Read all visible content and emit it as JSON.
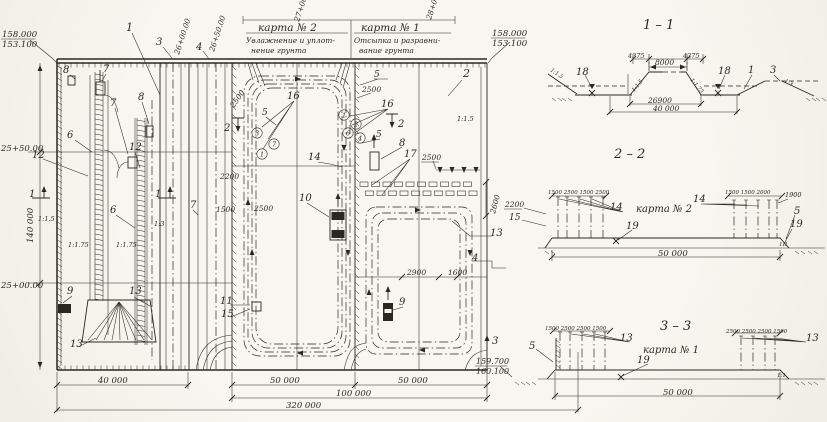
{
  "colors": {
    "paper": "#f6f4ed",
    "ink": "#2b2822"
  },
  "labels": [
    {
      "n": "elevation-top-left-upper",
      "t": "158.000",
      "x": 2,
      "y": 37,
      "fs": 8.5,
      "ul": 1
    },
    {
      "n": "elevation-top-left-lower",
      "t": "153.100",
      "x": 2,
      "y": 47,
      "fs": 8.5
    },
    {
      "n": "pos-1",
      "t": "1",
      "x": 126,
      "y": 31,
      "fs": 11
    },
    {
      "n": "pos-3",
      "t": "3",
      "x": 156,
      "y": 45,
      "fs": 10
    },
    {
      "n": "pos-4",
      "t": "4",
      "x": 196,
      "y": 50,
      "fs": 10
    },
    {
      "n": "station-axis-a",
      "t": "26+00.00",
      "x": 179,
      "y": 55,
      "fs": 7.5,
      "r": -72
    },
    {
      "n": "station-axis-b",
      "t": "26+50.00",
      "x": 214,
      "y": 52,
      "fs": 7.5,
      "r": -72
    },
    {
      "n": "station-axis-c",
      "t": "27+00",
      "x": 299,
      "y": 22,
      "fs": 7.5,
      "r": -72
    },
    {
      "n": "station-axis-d",
      "t": "28+00",
      "x": 431,
      "y": 20,
      "fs": 7.5,
      "r": -72
    },
    {
      "n": "map2-title",
      "t": "карта  № 2",
      "x": 258,
      "y": 31,
      "fs": 10.5
    },
    {
      "n": "map2-subtitle-1",
      "t": "Увлажнение и уплот-",
      "x": 246,
      "y": 43,
      "fs": 7.5
    },
    {
      "n": "map2-subtitle-2",
      "t": "нение грунта",
      "x": 251,
      "y": 53,
      "fs": 7.5
    },
    {
      "n": "map1-title",
      "t": "карта  № 1",
      "x": 361,
      "y": 31,
      "fs": 10.5
    },
    {
      "n": "map1-subtitle-1",
      "t": "Отсыпка и разравни-",
      "x": 354,
      "y": 43,
      "fs": 7.5
    },
    {
      "n": "map1-subtitle-2",
      "t": "вание грунта",
      "x": 359,
      "y": 53,
      "fs": 7.5
    },
    {
      "n": "elevation-top-right-upper",
      "t": "158.000",
      "x": 492,
      "y": 36,
      "fs": 8.5,
      "ul": 1
    },
    {
      "n": "elevation-top-right-lower",
      "t": "153.100",
      "x": 492,
      "y": 46,
      "fs": 8.5
    },
    {
      "n": "pos-2",
      "t": "2",
      "x": 463,
      "y": 77,
      "fs": 11
    },
    {
      "n": "slope-right-top",
      "t": "1:1.5",
      "x": 457,
      "y": 121,
      "fs": 6.5
    },
    {
      "n": "pos-8-a",
      "t": "8",
      "x": 63,
      "y": 73,
      "fs": 10
    },
    {
      "n": "pos-7-a",
      "t": "7",
      "x": 103,
      "y": 72,
      "fs": 10
    },
    {
      "n": "pos-7-b",
      "t": "7",
      "x": 110,
      "y": 106,
      "fs": 10
    },
    {
      "n": "pos-8-b",
      "t": "8",
      "x": 138,
      "y": 100,
      "fs": 10
    },
    {
      "n": "pos-6-a",
      "t": "6",
      "x": 67,
      "y": 138,
      "fs": 10
    },
    {
      "n": "pos-12-a",
      "t": "12",
      "x": 32,
      "y": 158,
      "fs": 10
    },
    {
      "n": "pos-12-b",
      "t": "12",
      "x": 129,
      "y": 150,
      "fs": 10
    },
    {
      "n": "pos-6-b",
      "t": "6",
      "x": 110,
      "y": 213,
      "fs": 10
    },
    {
      "n": "slope-a",
      "t": "1:1.5",
      "x": 38,
      "y": 221,
      "fs": 6.5
    },
    {
      "n": "slope-b",
      "t": "1:1.75",
      "x": 68,
      "y": 247,
      "fs": 6.5
    },
    {
      "n": "slope-c",
      "t": "1:1.75",
      "x": 116,
      "y": 247,
      "fs": 6.5
    },
    {
      "n": "slope-d",
      "t": "1:3",
      "x": 154,
      "y": 226,
      "fs": 6.5
    },
    {
      "n": "pos-7-c",
      "t": "7",
      "x": 190,
      "y": 208,
      "fs": 10
    },
    {
      "n": "pos-9-a",
      "t": "9",
      "x": 67,
      "y": 294,
      "fs": 10
    },
    {
      "n": "pos-13-a",
      "t": "13",
      "x": 129,
      "y": 294,
      "fs": 10
    },
    {
      "n": "pos-13-b",
      "t": "13",
      "x": 70,
      "y": 347,
      "fs": 10
    },
    {
      "n": "station-pk-25-50",
      "t": "25+50.00",
      "x": 1,
      "y": 151,
      "fs": 8.5
    },
    {
      "n": "station-pk-25-00",
      "t": "25+00.00",
      "x": 1,
      "y": 288,
      "fs": 8.5
    },
    {
      "n": "dim-140000",
      "t": "140 000",
      "x": 33,
      "y": 243,
      "fs": 8.5,
      "r": -90
    },
    {
      "n": "section-mark-1-left",
      "t": "1",
      "x": 29,
      "y": 197,
      "fs": 10
    },
    {
      "n": "section-mark-1-right",
      "t": "1",
      "x": 155,
      "y": 197,
      "fs": 10
    },
    {
      "n": "pos-5-a",
      "t": "5",
      "x": 262,
      "y": 115,
      "fs": 9
    },
    {
      "n": "route-point-3",
      "t": "3",
      "x": 257,
      "y": 133,
      "fs": 6.5,
      "c": 1
    },
    {
      "n": "route-point-7",
      "t": "7",
      "x": 274,
      "y": 144,
      "fs": 6.5,
      "c": 1
    },
    {
      "n": "route-point-1a",
      "t": "1",
      "x": 262,
      "y": 154,
      "fs": 6.5,
      "c": 1
    },
    {
      "n": "pos-16-a",
      "t": "16",
      "x": 287,
      "y": 99,
      "fs": 10
    },
    {
      "n": "dim-2500-a",
      "t": "2500",
      "x": 234,
      "y": 108,
      "fs": 7.5,
      "r": -55
    },
    {
      "n": "dim-2200-a",
      "t": "2200",
      "x": 220,
      "y": 179,
      "fs": 7.5
    },
    {
      "n": "dim-1500-a",
      "t": "1500",
      "x": 216,
      "y": 212,
      "fs": 7.5
    },
    {
      "n": "dim-2500-b",
      "t": "2500",
      "x": 254,
      "y": 211,
      "fs": 7.5
    },
    {
      "n": "section-mark-2-left",
      "t": "2",
      "x": 224,
      "y": 131,
      "fs": 10
    },
    {
      "n": "section-mark-2-right",
      "t": "2",
      "x": 398,
      "y": 127,
      "fs": 10
    },
    {
      "n": "pos-14-a",
      "t": "14",
      "x": 308,
      "y": 160,
      "fs": 10
    },
    {
      "n": "pos-10",
      "t": "10",
      "x": 299,
      "y": 201,
      "fs": 10
    },
    {
      "n": "pos-11",
      "t": "11",
      "x": 220,
      "y": 304,
      "fs": 10
    },
    {
      "n": "pos-15-a",
      "t": "15",
      "x": 221,
      "y": 317,
      "fs": 10
    },
    {
      "n": "route-point-1b",
      "t": "1",
      "x": 344,
      "y": 115,
      "fs": 6.5,
      "c": 1
    },
    {
      "n": "route-point-2",
      "t": "2",
      "x": 356,
      "y": 124,
      "fs": 6.5,
      "c": 1
    },
    {
      "n": "route-point-6",
      "t": "6",
      "x": 348,
      "y": 133,
      "fs": 6.5,
      "c": 1
    },
    {
      "n": "route-point-4",
      "t": "4",
      "x": 360,
      "y": 138,
      "fs": 6.5,
      "c": 1
    },
    {
      "n": "pos-5-b",
      "t": "5",
      "x": 374,
      "y": 77,
      "fs": 9
    },
    {
      "n": "dim-2500-c",
      "t": "2500",
      "x": 362,
      "y": 92,
      "fs": 7.5
    },
    {
      "n": "pos-16-b",
      "t": "16",
      "x": 381,
      "y": 107,
      "fs": 10
    },
    {
      "n": "pos-5-c",
      "t": "5",
      "x": 376,
      "y": 137,
      "fs": 9
    },
    {
      "n": "pos-8-c",
      "t": "8",
      "x": 399,
      "y": 146,
      "fs": 10
    },
    {
      "n": "pos-17",
      "t": "17",
      "x": 404,
      "y": 157,
      "fs": 10
    },
    {
      "n": "dim-2500-d",
      "t": "2500",
      "x": 422,
      "y": 160,
      "fs": 7.5,
      "ul": 1
    },
    {
      "n": "dim-2600",
      "t": "2600",
      "x": 495,
      "y": 214,
      "fs": 7.5,
      "r": -75
    },
    {
      "n": "pos-13-c",
      "t": "13",
      "x": 490,
      "y": 236,
      "fs": 10
    },
    {
      "n": "pos-4-b",
      "t": "4",
      "x": 472,
      "y": 261,
      "fs": 10
    },
    {
      "n": "dim-2900",
      "t": "2900",
      "x": 407,
      "y": 275,
      "fs": 7.5
    },
    {
      "n": "dim-1600",
      "t": "1600",
      "x": 448,
      "y": 275,
      "fs": 7.5
    },
    {
      "n": "pos-9-b",
      "t": "9",
      "x": 399,
      "y": 305,
      "fs": 10
    },
    {
      "n": "section-mark-3",
      "t": "3",
      "x": 492,
      "y": 344,
      "fs": 10
    },
    {
      "n": "dim-40000-plan",
      "t": "40 000",
      "x": 98,
      "y": 383,
      "fs": 8.5
    },
    {
      "n": "dim-50000-plan-a",
      "t": "50 000",
      "x": 270,
      "y": 383,
      "fs": 8.5
    },
    {
      "n": "dim-50000-plan-b",
      "t": "50 000",
      "x": 398,
      "y": 383,
      "fs": 8.5
    },
    {
      "n": "dim-100000-plan",
      "t": "100 000",
      "x": 336,
      "y": 396,
      "fs": 8.5
    },
    {
      "n": "dim-320000-plan",
      "t": "320 000",
      "x": 286,
      "y": 408,
      "fs": 8.5
    },
    {
      "n": "elevation-bottom-right-upper",
      "t": "159.700",
      "x": 476,
      "y": 364,
      "fs": 8,
      "ul": 1
    },
    {
      "n": "elevation-bottom-right-lower",
      "t": "160.100",
      "x": 476,
      "y": 374,
      "fs": 8
    },
    {
      "n": "section-1-1-title",
      "t": "1 – 1",
      "x": 643,
      "y": 29,
      "fs": 13
    },
    {
      "n": "pos-18-a",
      "t": "18",
      "x": 576,
      "y": 75,
      "fs": 10
    },
    {
      "n": "slope-s1-left",
      "t": "1:1.5",
      "x": 550,
      "y": 71,
      "fs": 5.5,
      "r": 33
    },
    {
      "n": "dim-4375-left",
      "t": "4375",
      "x": 628,
      "y": 58,
      "fs": 6.5
    },
    {
      "n": "dim-8000",
      "t": "8000",
      "x": 655,
      "y": 65,
      "fs": 7.5
    },
    {
      "n": "dim-4375-right",
      "t": "4375",
      "x": 683,
      "y": 58,
      "fs": 6.5
    },
    {
      "n": "slope-s1-core-left",
      "t": "1:1.5",
      "x": 634,
      "y": 92,
      "fs": 5.5,
      "r": -50
    },
    {
      "n": "slope-s1-core-right",
      "t": "1:1.75",
      "x": 690,
      "y": 80,
      "fs": 5.5,
      "r": 50
    },
    {
      "n": "pos-18-b",
      "t": "18",
      "x": 718,
      "y": 74,
      "fs": 10
    },
    {
      "n": "pos-1-b",
      "t": "1",
      "x": 748,
      "y": 73,
      "fs": 10
    },
    {
      "n": "pos-3-b",
      "t": "3",
      "x": 770,
      "y": 73,
      "fs": 10
    },
    {
      "n": "slope-s1-right",
      "t": "1:3",
      "x": 784,
      "y": 82,
      "fs": 5.5,
      "r": 28
    },
    {
      "n": "dim-26900",
      "t": "26900",
      "x": 648,
      "y": 103,
      "fs": 7.5
    },
    {
      "n": "dim-40000-s1",
      "t": "40 000",
      "x": 653,
      "y": 111,
      "fs": 7.5
    },
    {
      "n": "section-2-2-title",
      "t": "2 – 2",
      "x": 614,
      "y": 158,
      "fs": 13
    },
    {
      "n": "dim-2200-s2",
      "t": "2200",
      "x": 505,
      "y": 207,
      "fs": 7.5,
      "ul": 1
    },
    {
      "n": "pos-15-b",
      "t": "15",
      "x": 509,
      "y": 220,
      "fs": 9
    },
    {
      "n": "dims-s2-left",
      "t": "1500 2500 1500 2500",
      "x": 548,
      "y": 194,
      "fs": 5.5
    },
    {
      "n": "pos-14-b",
      "t": "14",
      "x": 610,
      "y": 210,
      "fs": 10
    },
    {
      "n": "map2-ref-s2",
      "t": "карта № 2",
      "x": 636,
      "y": 212,
      "fs": 10
    },
    {
      "n": "pos-19-a",
      "t": "19",
      "x": 626,
      "y": 229,
      "fs": 10
    },
    {
      "n": "dims-s2-right",
      "t": "1500 1500 2000",
      "x": 725,
      "y": 194,
      "fs": 5.5
    },
    {
      "n": "dim-1900-s2",
      "t": "1900",
      "x": 785,
      "y": 197,
      "fs": 6.5
    },
    {
      "n": "pos-14-c",
      "t": "14",
      "x": 693,
      "y": 202,
      "fs": 10
    },
    {
      "n": "pos-5-d",
      "t": "5",
      "x": 794,
      "y": 214,
      "fs": 10
    },
    {
      "n": "pos-19-b",
      "t": "19",
      "x": 790,
      "y": 227,
      "fs": 10
    },
    {
      "n": "slope-s2-right",
      "t": "1:1",
      "x": 779,
      "y": 246,
      "fs": 5.5
    },
    {
      "n": "dim-50000-s2",
      "t": "50 000",
      "x": 658,
      "y": 256,
      "fs": 8.5
    },
    {
      "n": "section-3-3-title",
      "t": "3 – 3",
      "x": 660,
      "y": 330,
      "fs": 13
    },
    {
      "n": "pos-5-e",
      "t": "5",
      "x": 529,
      "y": 349,
      "fs": 10
    },
    {
      "n": "dims-s3-left",
      "t": "1500 2500 2500 1500",
      "x": 545,
      "y": 330,
      "fs": 5.5
    },
    {
      "n": "pos-13-d",
      "t": "13",
      "x": 620,
      "y": 341,
      "fs": 10
    },
    {
      "n": "map1-ref-s3",
      "t": "карта № 1",
      "x": 643,
      "y": 353,
      "fs": 10
    },
    {
      "n": "pos-19-c",
      "t": "19",
      "x": 637,
      "y": 363,
      "fs": 10
    },
    {
      "n": "dims-s3-right",
      "t": "2500 2500 2500 1500",
      "x": 726,
      "y": 333,
      "fs": 5.5
    },
    {
      "n": "pos-13-e",
      "t": "13",
      "x": 806,
      "y": 341,
      "fs": 10
    },
    {
      "n": "slope-s3-right",
      "t": "1:1",
      "x": 777,
      "y": 377,
      "fs": 5.5
    },
    {
      "n": "dim-50000-s3",
      "t": "50 000",
      "x": 663,
      "y": 395,
      "fs": 8.5
    }
  ]
}
